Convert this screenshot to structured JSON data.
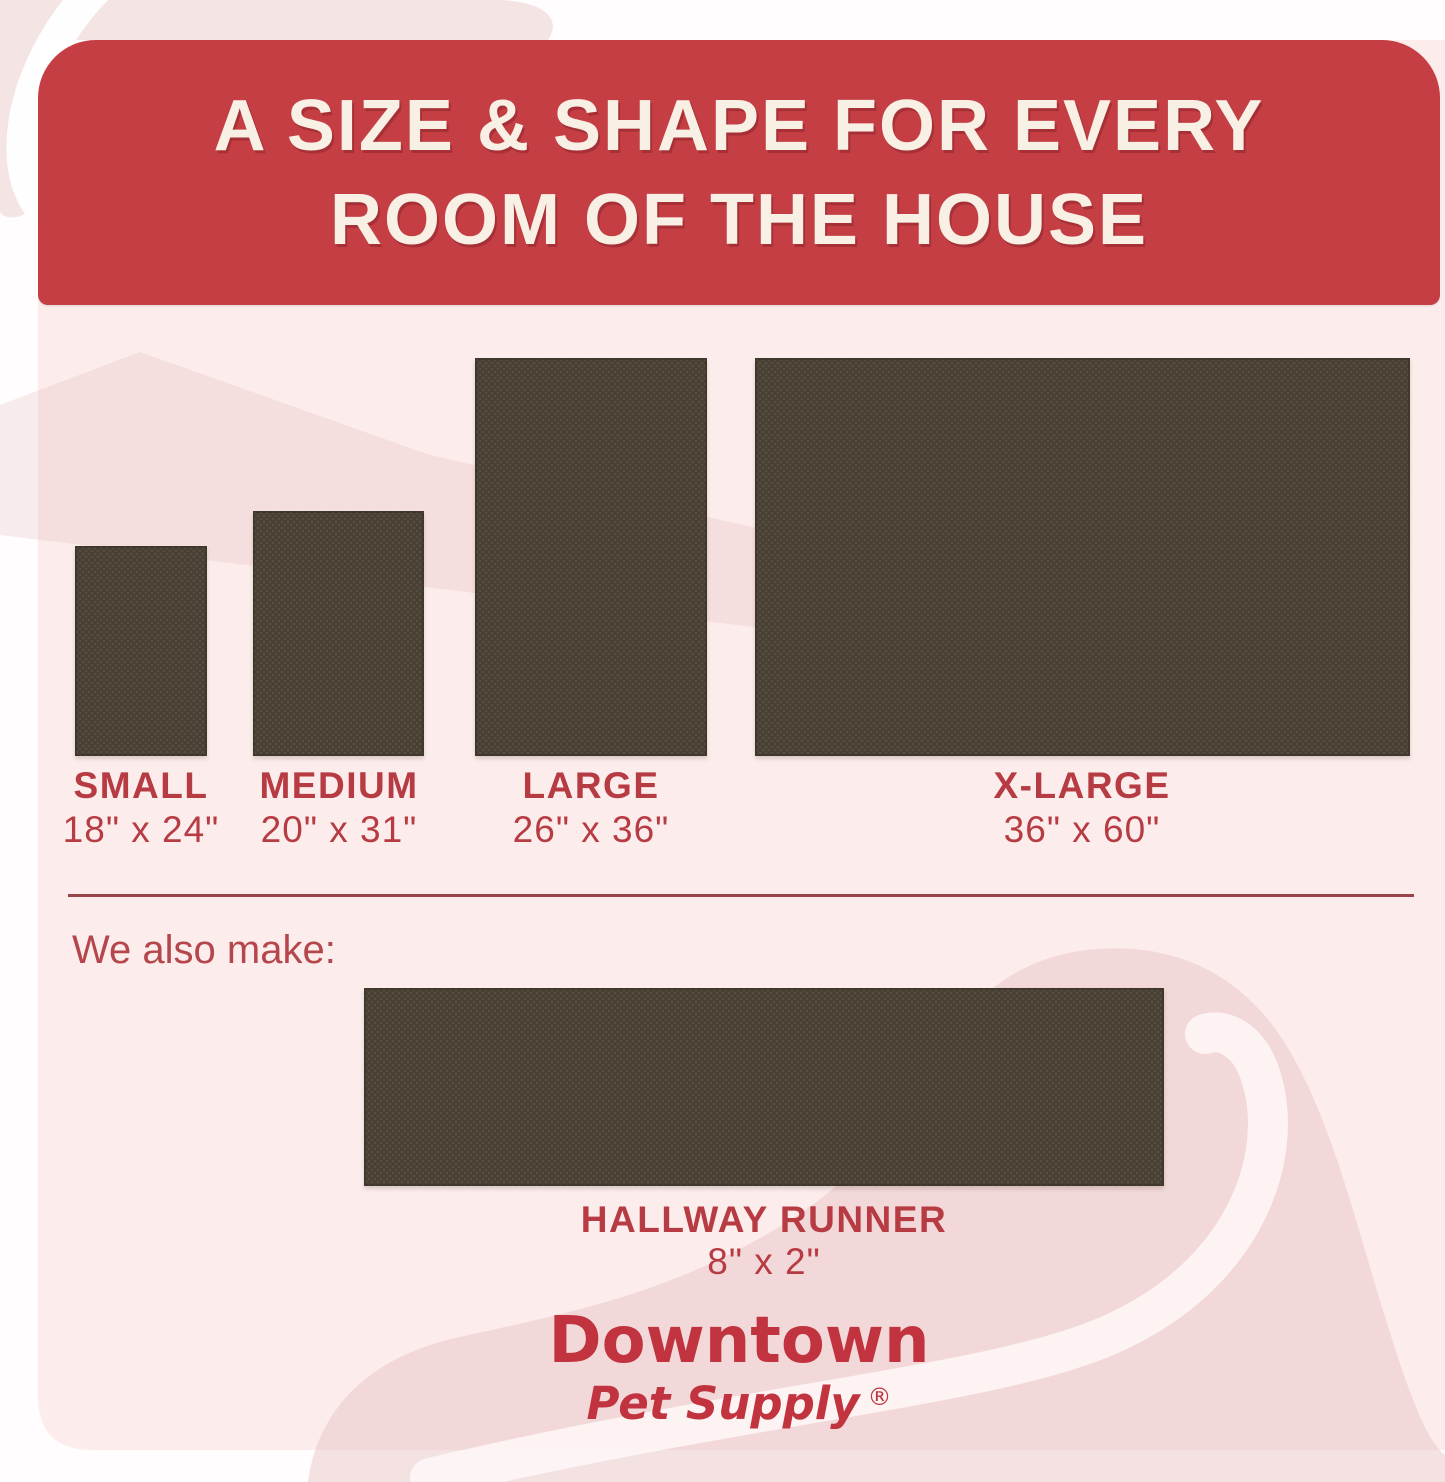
{
  "header": {
    "line1": "A SIZE & SHAPE FOR EVERY",
    "line2": "ROOM OF THE HOUSE"
  },
  "sizes": [
    {
      "name": "SMALL",
      "dims": "18\" x 24\""
    },
    {
      "name": "MEDIUM",
      "dims": "20\" x 31\""
    },
    {
      "name": "LARGE",
      "dims": "26\" x 36\""
    },
    {
      "name": "X-LARGE",
      "dims": "36\" x 60\""
    }
  ],
  "also_make": {
    "label": "We also make:"
  },
  "runner": {
    "name": "HALLWAY RUNNER",
    "dims": "8\" x 2\""
  },
  "brand": {
    "name": "Downtown",
    "sub": "Pet Supply",
    "registered": "®"
  },
  "colors": {
    "banner_red": "#c43e44",
    "header_text": "#f8efe5",
    "label_red": "#b73b42",
    "divider_red": "#9c4349",
    "logo_red": "#c1333e",
    "mat_brown": "#483f34",
    "mat_dot": "#584e40",
    "panel_pink": "#fcedec",
    "swirl_pink": "#f3dada",
    "page_white": "#fffdfd"
  }
}
